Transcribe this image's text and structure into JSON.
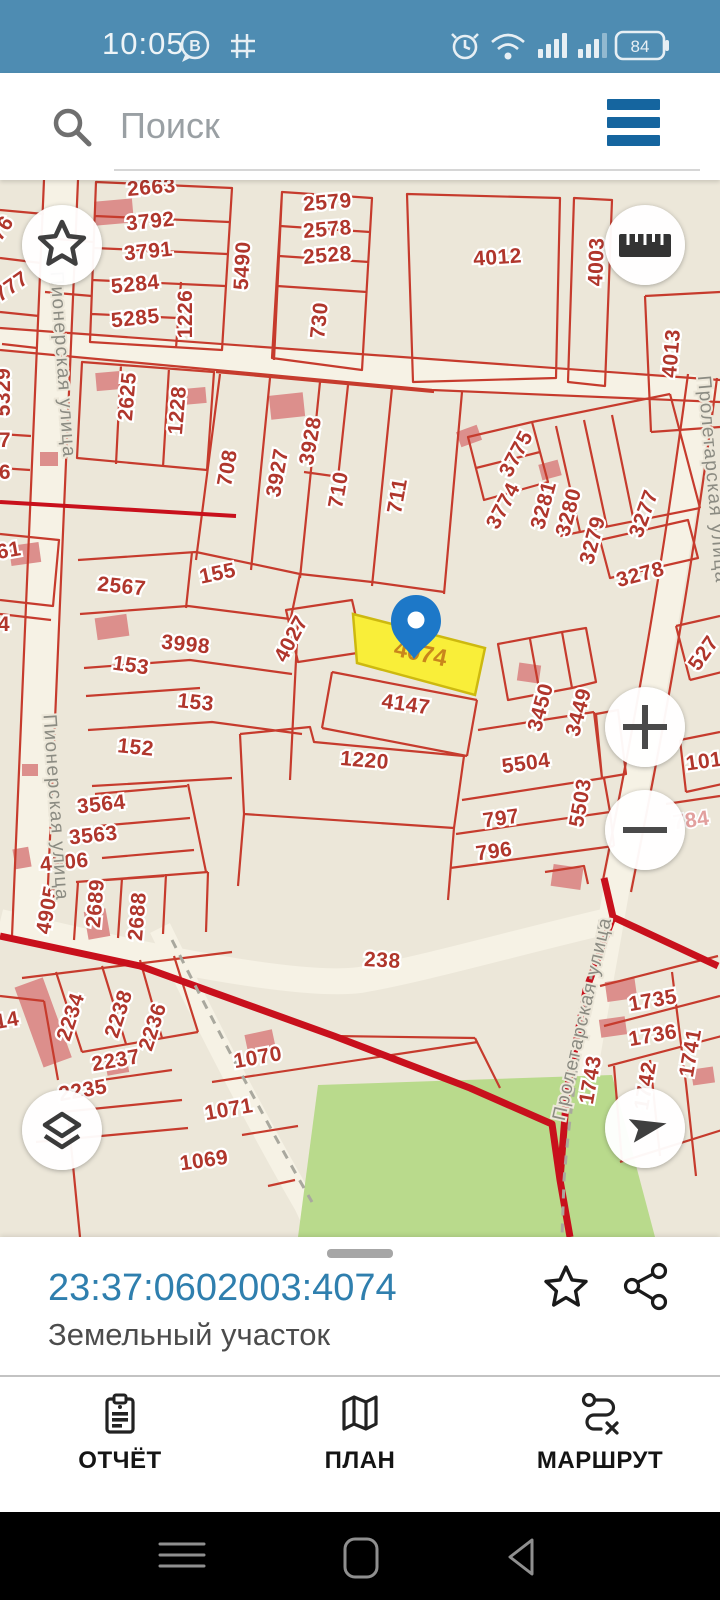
{
  "status_bar": {
    "time": "10:05",
    "battery": "84",
    "icons": [
      "b-badge",
      "sudoku-grid",
      "alarm",
      "wifi",
      "signal-1",
      "signal-2",
      "battery"
    ]
  },
  "search": {
    "placeholder": "Поиск"
  },
  "map": {
    "selected_parcel": {
      "label": "4074",
      "fill": "#f9ee39",
      "border": "#cdb90f",
      "label_color": "#c9861c"
    },
    "pin_color": "#1d78c8",
    "colors": {
      "background": "#ece7d9",
      "parcel_line": "#c63b2d",
      "label_red": "#b0362c",
      "boundary_thick": "#c8101c",
      "road": "#f6f2e5",
      "green_area": "#b9da8c",
      "building": "#dc8f8c",
      "street_label": "#8b8b82"
    },
    "controls": {
      "favorites": "star-icon",
      "measure": "ruler-icon",
      "zoom_in": "plus-icon",
      "zoom_out": "minus-icon",
      "layers": "layers-icon",
      "locate": "navigation-arrow-icon"
    },
    "labels": [
      {
        "t": "776",
        "x": 4,
        "y": 57,
        "r": -55
      },
      {
        "t": "777",
        "x": 15,
        "y": 112,
        "r": -35
      },
      {
        "t": "2663",
        "x": 152,
        "y": 14,
        "r": -5
      },
      {
        "t": "3792",
        "x": 151,
        "y": 48,
        "r": -6
      },
      {
        "t": "3791",
        "x": 149,
        "y": 78,
        "r": -6
      },
      {
        "t": "5284",
        "x": 136,
        "y": 111,
        "r": -6
      },
      {
        "t": "5285",
        "x": 136,
        "y": 145,
        "r": -6
      },
      {
        "t": "1226",
        "x": 192,
        "y": 134,
        "r": -90
      },
      {
        "t": "5490",
        "x": 249,
        "y": 86,
        "r": -87
      },
      {
        "t": "730",
        "x": 326,
        "y": 141,
        "r": -84
      },
      {
        "t": "2579",
        "x": 328,
        "y": 29,
        "r": -5
      },
      {
        "t": "2578",
        "x": 328,
        "y": 56,
        "r": -5
      },
      {
        "t": "2528",
        "x": 328,
        "y": 82,
        "r": -5
      },
      {
        "t": "4012",
        "x": 498,
        "y": 84,
        "r": -4
      },
      {
        "t": "4003",
        "x": 603,
        "y": 82,
        "r": -88
      },
      {
        "t": "4013",
        "x": 678,
        "y": 174,
        "r": -85
      },
      {
        "t": "5329",
        "x": 10,
        "y": 212,
        "r": -90
      },
      {
        "t": "7",
        "x": 5,
        "y": 267,
        "r": 0
      },
      {
        "t": "6",
        "x": 5,
        "y": 299,
        "r": 0
      },
      {
        "t": "61",
        "x": 10,
        "y": 377,
        "r": -10
      },
      {
        "t": "4",
        "x": 4,
        "y": 451,
        "r": 0
      },
      {
        "t": "2625",
        "x": 134,
        "y": 217,
        "r": -85
      },
      {
        "t": "1228",
        "x": 184,
        "y": 231,
        "r": -85
      },
      {
        "t": "708",
        "x": 234,
        "y": 289,
        "r": -80
      },
      {
        "t": "3927",
        "x": 284,
        "y": 294,
        "r": -80
      },
      {
        "t": "3928",
        "x": 317,
        "y": 262,
        "r": -80
      },
      {
        "t": "710",
        "x": 345,
        "y": 311,
        "r": -80
      },
      {
        "t": "711",
        "x": 404,
        "y": 317,
        "r": -80
      },
      {
        "t": "3775",
        "x": 522,
        "y": 277,
        "r": -62
      },
      {
        "t": "3774",
        "x": 509,
        "y": 329,
        "r": -62
      },
      {
        "t": "3281",
        "x": 550,
        "y": 327,
        "r": -75
      },
      {
        "t": "3280",
        "x": 575,
        "y": 334,
        "r": -75
      },
      {
        "t": "3279",
        "x": 599,
        "y": 362,
        "r": -75
      },
      {
        "t": "3277",
        "x": 650,
        "y": 336,
        "r": -70
      },
      {
        "t": "3278",
        "x": 642,
        "y": 401,
        "r": -15
      },
      {
        "t": "527",
        "x": 709,
        "y": 477,
        "r": -55
      },
      {
        "t": "2567",
        "x": 121,
        "y": 413,
        "r": 6
      },
      {
        "t": "155",
        "x": 219,
        "y": 400,
        "r": -12
      },
      {
        "t": "3998",
        "x": 185,
        "y": 471,
        "r": 6
      },
      {
        "t": "153",
        "x": 130,
        "y": 492,
        "r": 8
      },
      {
        "t": "153",
        "x": 195,
        "y": 529,
        "r": 6
      },
      {
        "t": "152",
        "x": 135,
        "y": 574,
        "r": 6
      },
      {
        "t": "4027",
        "x": 297,
        "y": 462,
        "r": -62
      },
      {
        "t": "4147",
        "x": 405,
        "y": 531,
        "r": 8
      },
      {
        "t": "3450",
        "x": 547,
        "y": 529,
        "r": -75
      },
      {
        "t": "3449",
        "x": 585,
        "y": 534,
        "r": -75
      },
      {
        "t": "1220",
        "x": 364,
        "y": 587,
        "r": 5
      },
      {
        "t": "5504",
        "x": 527,
        "y": 590,
        "r": -8
      },
      {
        "t": "5503",
        "x": 587,
        "y": 624,
        "r": -80
      },
      {
        "t": "797",
        "x": 502,
        "y": 645,
        "r": -8
      },
      {
        "t": "796",
        "x": 495,
        "y": 678,
        "r": -8
      },
      {
        "t": "101",
        "x": 705,
        "y": 588,
        "r": -8
      },
      {
        "t": "784",
        "x": 692,
        "y": 647,
        "r": -8,
        "c": "pink"
      },
      {
        "t": "238",
        "x": 382,
        "y": 787,
        "r": 3
      },
      {
        "t": "3564",
        "x": 102,
        "y": 631,
        "r": -6
      },
      {
        "t": "3563",
        "x": 94,
        "y": 662,
        "r": -6
      },
      {
        "t": "4906",
        "x": 65,
        "y": 689,
        "r": -6
      },
      {
        "t": "4905",
        "x": 54,
        "y": 731,
        "r": -80
      },
      {
        "t": "2689",
        "x": 102,
        "y": 724,
        "r": -85
      },
      {
        "t": "2688",
        "x": 144,
        "y": 737,
        "r": -85
      },
      {
        "t": "14",
        "x": 8,
        "y": 847,
        "r": -10
      },
      {
        "t": "2234",
        "x": 77,
        "y": 839,
        "r": -72
      },
      {
        "t": "2238",
        "x": 125,
        "y": 836,
        "r": -72
      },
      {
        "t": "2236",
        "x": 159,
        "y": 849,
        "r": -72
      },
      {
        "t": "2237",
        "x": 117,
        "y": 887,
        "r": -10
      },
      {
        "t": "2235",
        "x": 84,
        "y": 917,
        "r": -10
      },
      {
        "t": "1070",
        "x": 259,
        "y": 884,
        "r": -10
      },
      {
        "t": "1071",
        "x": 230,
        "y": 936,
        "r": -10
      },
      {
        "t": "1069",
        "x": 205,
        "y": 987,
        "r": -8
      },
      {
        "t": "1735",
        "x": 654,
        "y": 827,
        "r": -10
      },
      {
        "t": "1736",
        "x": 654,
        "y": 862,
        "r": -10
      },
      {
        "t": "1741",
        "x": 697,
        "y": 874,
        "r": -80
      },
      {
        "t": "1743",
        "x": 597,
        "y": 901,
        "r": -80
      },
      {
        "t": "1742",
        "x": 652,
        "y": 907,
        "r": -80
      }
    ],
    "streets": [
      {
        "t": "Пионерская улица",
        "x": 57,
        "y": 185,
        "r": 86
      },
      {
        "t": "Пионерская улица",
        "x": 50,
        "y": 628,
        "r": 86
      },
      {
        "t": "Пролетарская улица",
        "x": 707,
        "y": 300,
        "r": 85
      },
      {
        "t": "Пролетарская улица",
        "x": 588,
        "y": 840,
        "r": -77
      }
    ]
  },
  "bottom_sheet": {
    "cadastral_number": "23:37:0602003:4074",
    "subtitle": "Земельный участок"
  },
  "bottom_nav": {
    "items": [
      {
        "label": "ОТЧЁТ",
        "icon": "clipboard"
      },
      {
        "label": "ПЛАН",
        "icon": "folded-map"
      },
      {
        "label": "МАРШРУТ",
        "icon": "route-path"
      }
    ]
  },
  "android_bar": {
    "icons": [
      "recents-hamburger",
      "home-square",
      "back-triangle"
    ]
  }
}
